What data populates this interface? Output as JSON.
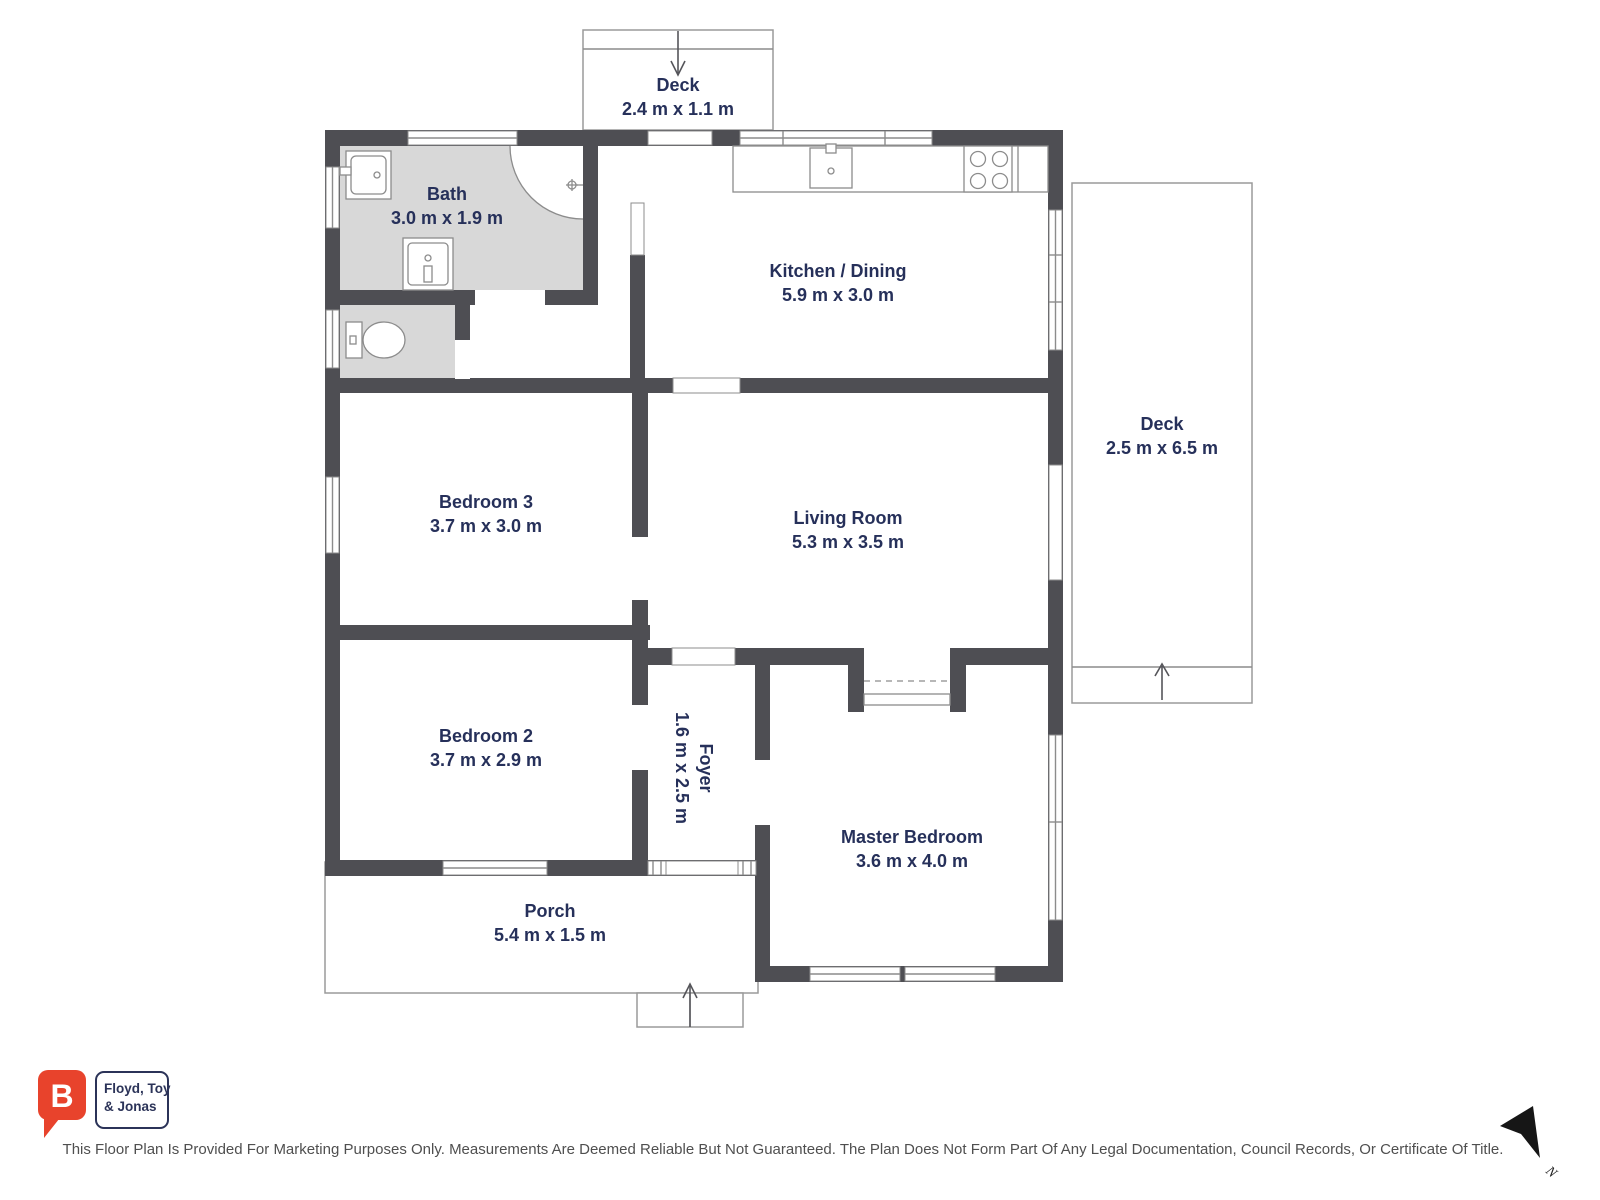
{
  "floorplan": {
    "rooms": {
      "deck_top": {
        "name": "Deck",
        "dims": "2.4 m x 1.1 m"
      },
      "bath": {
        "name": "Bath",
        "dims": "3.0 m x 1.9 m"
      },
      "kitchen_dining": {
        "name": "Kitchen / Dining",
        "dims": "5.9 m x 3.0 m"
      },
      "deck_right": {
        "name": "Deck",
        "dims": "2.5 m x 6.5 m"
      },
      "bedroom3": {
        "name": "Bedroom 3",
        "dims": "3.7 m x 3.0 m"
      },
      "living_room": {
        "name": "Living Room",
        "dims": "5.3 m x 3.5 m"
      },
      "bedroom2": {
        "name": "Bedroom 2",
        "dims": "3.7 m x 2.9 m"
      },
      "foyer": {
        "name": "Foyer",
        "dims": "1.6 m x 2.5 m"
      },
      "master_bedroom": {
        "name": "Master Bedroom",
        "dims": "3.6 m x 4.0 m"
      },
      "porch": {
        "name": "Porch",
        "dims": "5.4 m x 1.5 m"
      }
    }
  },
  "branding": {
    "logo_letter": "B",
    "agency_name_line1": "Floyd, Toy",
    "agency_name_line2": "& Jonas"
  },
  "compass": {
    "north_label": "N"
  },
  "footer": {
    "disclaimer": "This Floor Plan Is Provided For Marketing Purposes Only. Measurements Are Deemed Reliable But Not Guaranteed. The Plan Does Not Form Part Of Any Legal Documentation, Council Records, Or Certificate Of Title."
  },
  "colors": {
    "wall": "#4e4e53",
    "room_fill_wet": "#d8d8d8",
    "label": "#26305a",
    "fixture_line": "#8c8c8c",
    "logo_red": "#e8432c",
    "logo_navy": "#2b3358",
    "disclaimer_text": "#4f4f4f"
  }
}
